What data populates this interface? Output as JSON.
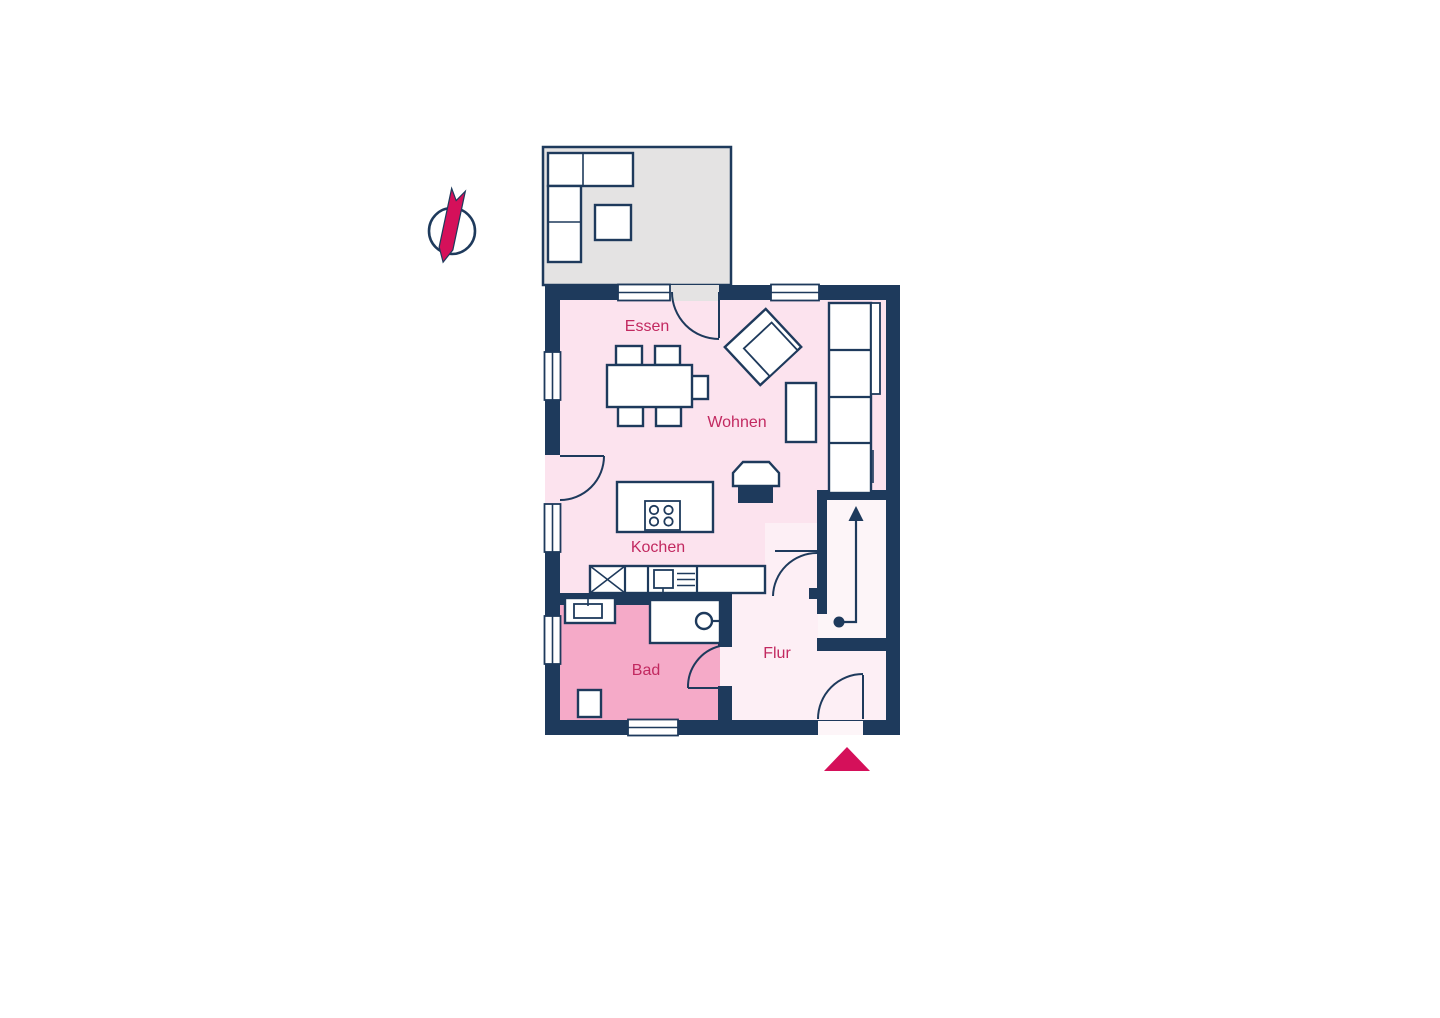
{
  "colors": {
    "wall": "#1e3a5c",
    "accent": "#d5105a",
    "label": "#c22960",
    "room_main": "#fce3ee",
    "room_bad": "#f5aac8",
    "room_flur": "#fdeff5",
    "room_stair": "#fdf5f8",
    "terrace": "#e4e3e3"
  },
  "floorplan": {
    "type": "apartment-floor-plan",
    "rooms": [
      {
        "id": "essen",
        "label": "Essen"
      },
      {
        "id": "wohnen",
        "label": "Wohnen"
      },
      {
        "id": "kochen",
        "label": "Kochen"
      },
      {
        "id": "bad",
        "label": "Bad"
      },
      {
        "id": "flur",
        "label": "Flur"
      }
    ],
    "outdoor_area": {
      "id": "terrace",
      "label": ""
    },
    "markers": {
      "north": "compass-north-arrow",
      "entrance": "entrance-arrow-triangle",
      "stairs": "stair-direction-arrow"
    },
    "furniture": [
      "corner-bench",
      "terrace-table",
      "dining-table",
      "dining-chairs",
      "armchair",
      "sideboard",
      "sofa",
      "kitchen-island",
      "cooktop",
      "kitchen-counter",
      "sink",
      "oven",
      "washbasin",
      "washing-machine",
      "shower-stool",
      "fireplace-chair"
    ]
  }
}
